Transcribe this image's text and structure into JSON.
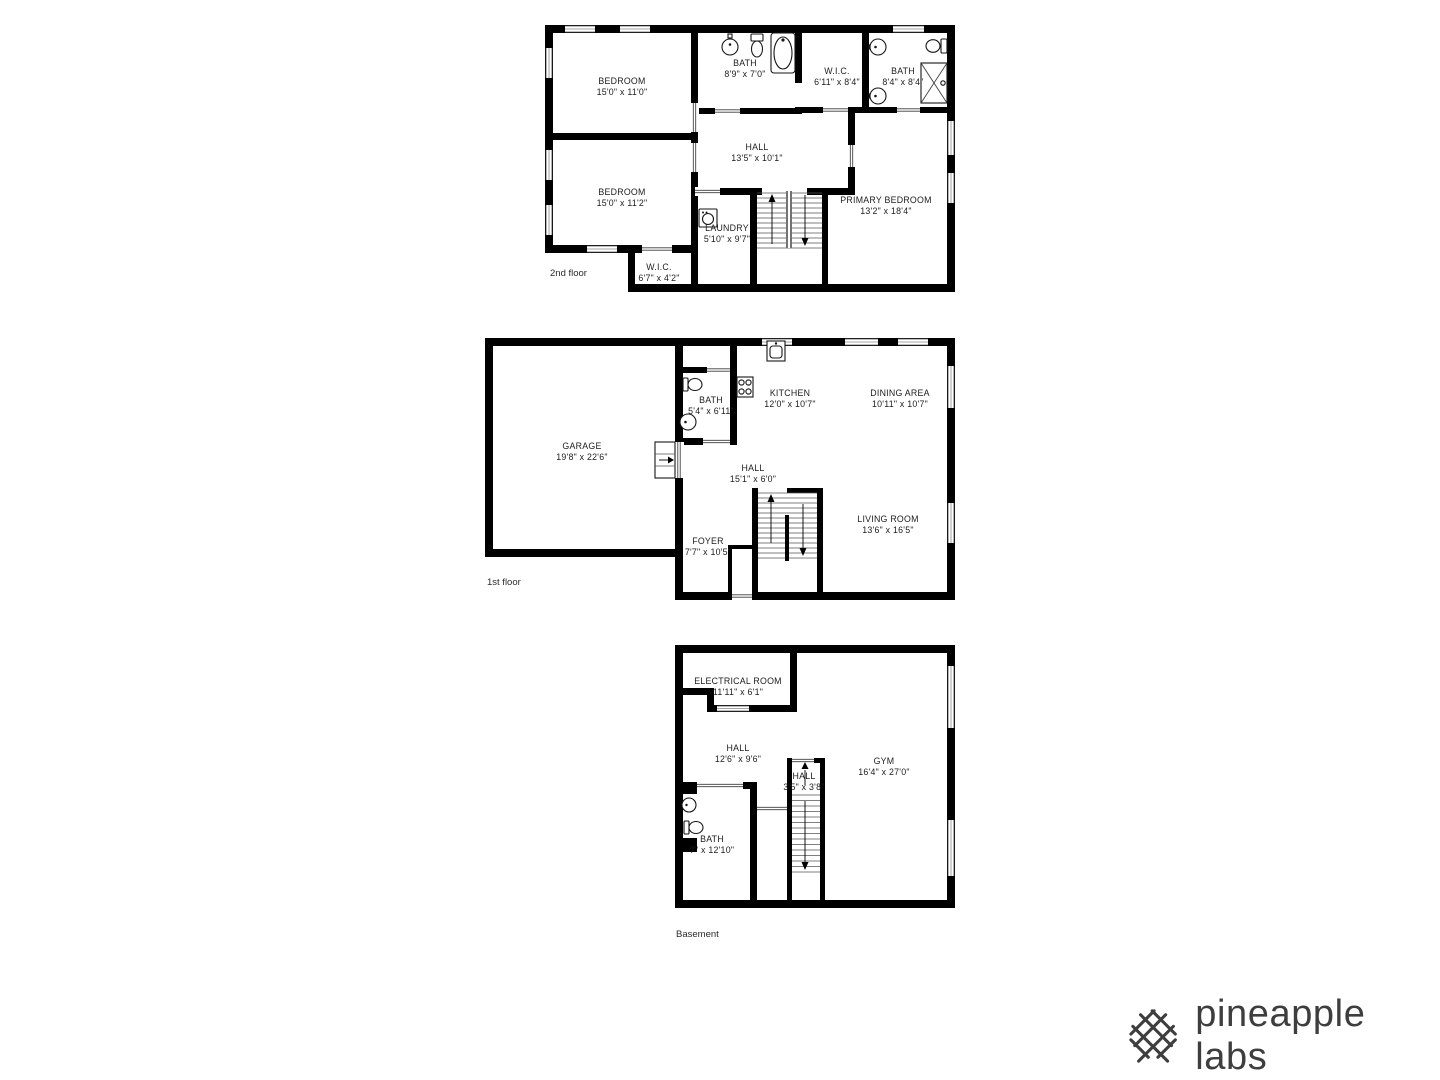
{
  "floors": [
    {
      "label": "2nd floor",
      "rooms": [
        {
          "name": "BEDROOM",
          "dims": "15'0\" x 11'0\""
        },
        {
          "name": "BEDROOM",
          "dims": "15'0\" x 11'2\""
        },
        {
          "name": "BATH",
          "dims": "8'9\" x 7'0\""
        },
        {
          "name": "W.I.C.",
          "dims": "6'11\" x 8'4\""
        },
        {
          "name": "BATH",
          "dims": "8'4\" x 8'4\""
        },
        {
          "name": "HALL",
          "dims": "13'5\" x 10'1\""
        },
        {
          "name": "PRIMARY BEDROOM",
          "dims": "13'2\" x 18'4\""
        },
        {
          "name": "LAUNDRY",
          "dims": "5'10\" x 9'7\""
        },
        {
          "name": "W.I.C.",
          "dims": "6'7\" x 4'2\""
        }
      ],
      "fixtures": [
        "sink",
        "toilet",
        "bathtub",
        "sink",
        "sink",
        "toilet",
        "shower",
        "washer"
      ]
    },
    {
      "label": "1st floor",
      "rooms": [
        {
          "name": "GARAGE",
          "dims": "19'8\" x 22'6\""
        },
        {
          "name": "BATH",
          "dims": "5'4\" x 6'11\""
        },
        {
          "name": "KITCHEN",
          "dims": "12'0\" x 10'7\""
        },
        {
          "name": "DINING AREA",
          "dims": "10'11\" x 10'7\""
        },
        {
          "name": "HALL",
          "dims": "15'1\" x 6'0\""
        },
        {
          "name": "FOYER",
          "dims": "7'7\" x 10'5\""
        },
        {
          "name": "LIVING ROOM",
          "dims": "13'6\" x 16'5\""
        }
      ],
      "fixtures": [
        "kitchen-sink",
        "stove",
        "toilet",
        "sink"
      ]
    },
    {
      "label": "Basement",
      "rooms": [
        {
          "name": "ELECTRICAL ROOM",
          "dims": "11'11\" x 6'1\""
        },
        {
          "name": "HALL",
          "dims": "12'6\" x 9'6\""
        },
        {
          "name": "HALL",
          "dims": "3'5\" x 3'8\""
        },
        {
          "name": "GYM",
          "dims": "16'4\" x 27'0\""
        },
        {
          "name": "BATH",
          "dims": "7\" x 12'10\""
        }
      ],
      "fixtures": [
        "sink",
        "toilet"
      ]
    }
  ],
  "branding": {
    "logo_text": "pineapple labs"
  },
  "colors": {
    "wall": "#000000",
    "background": "#ffffff",
    "logo": "#3e3e3e",
    "label_text": "#1c1c1c"
  }
}
